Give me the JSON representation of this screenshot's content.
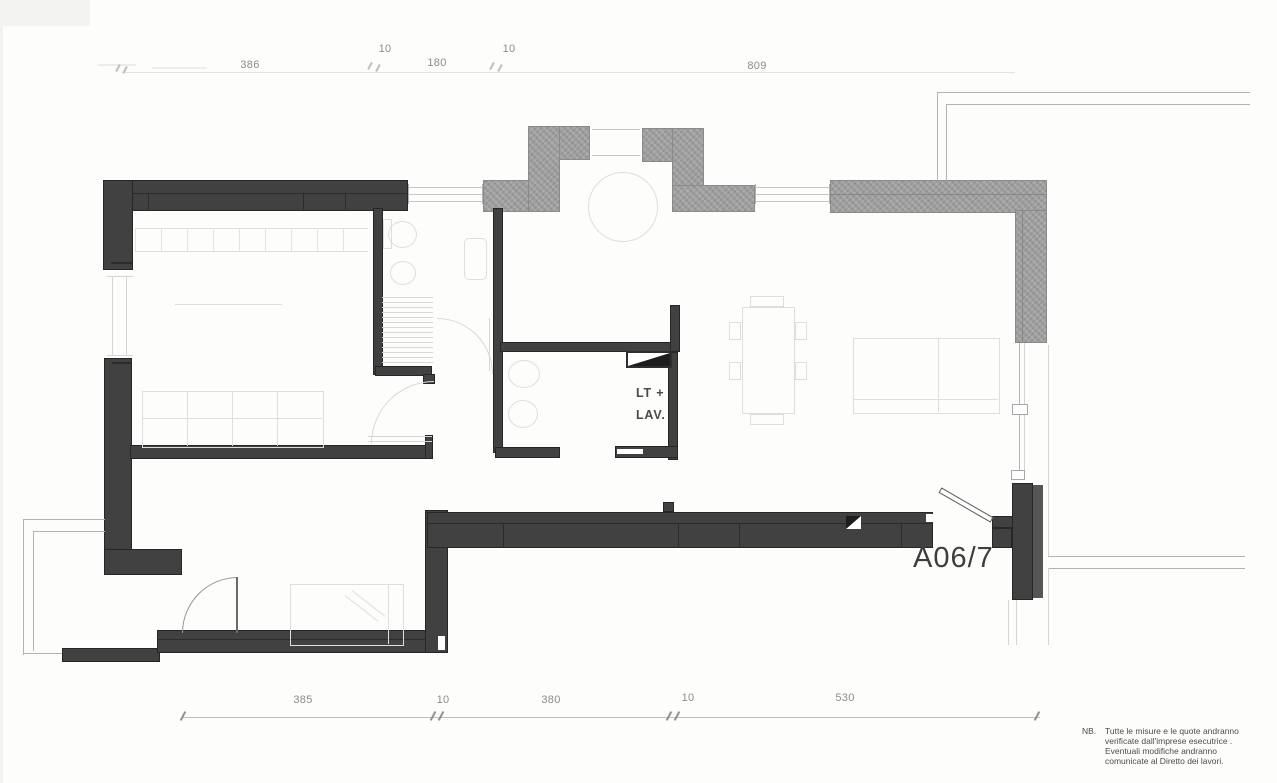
{
  "plan": {
    "unit_label": "A06/7",
    "utility_room_label": {
      "line1": "LT +",
      "line2": "LAV."
    },
    "dimensions": {
      "top": [
        "386",
        "10",
        "180",
        "10",
        "809"
      ],
      "bottom": [
        "385",
        "10",
        "380",
        "10",
        "530"
      ]
    },
    "note": {
      "prefix": "NB.",
      "line1": "Tutte le misure e le quote andranno",
      "line2": "verificate dall'imprese esecutrice .",
      "line3": "Eventuali modifiche andranno",
      "line4": "comunicate al Diretto dei lavori."
    },
    "colors": {
      "wall_new": "#414141",
      "wall_existing": "#9e9e9e",
      "furniture_line": "#dedede",
      "dimension_text": "#8c8c8c",
      "label_text": "#3e3e3e"
    }
  }
}
